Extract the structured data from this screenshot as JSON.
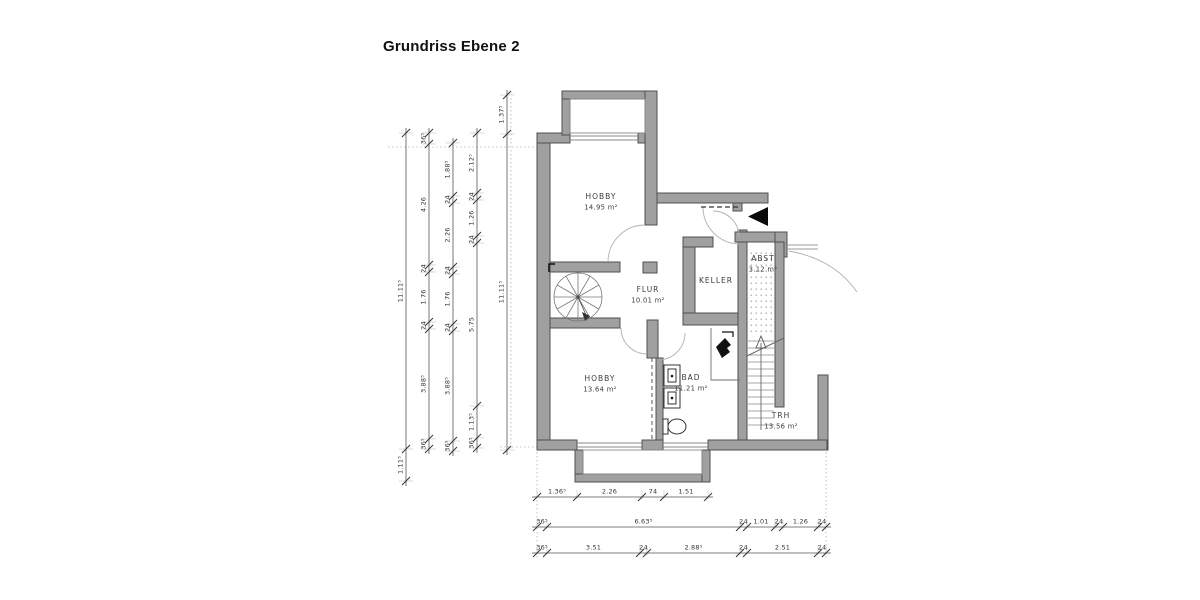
{
  "title": "Grundriss Ebene 2",
  "rooms": [
    {
      "name": "HOBBY",
      "area": "14.95 m²",
      "x": 601,
      "y": 199
    },
    {
      "name": "FLUR",
      "area": "10.01 m²",
      "x": 648,
      "y": 292
    },
    {
      "name": "KELLER",
      "area": "",
      "x": 716,
      "y": 283
    },
    {
      "name": "ABST",
      "area": "3.12 m²",
      "x": 763,
      "y": 261
    },
    {
      "name": "HOBBY",
      "area": "13.64 m²",
      "x": 600,
      "y": 381
    },
    {
      "name": "BAD",
      "area": "11.21 m²",
      "x": 691,
      "y": 380
    },
    {
      "name": "TRH",
      "area": "13.56 m²",
      "x": 781,
      "y": 418
    }
  ],
  "dim_chains": [
    {
      "dir": "v",
      "pos": 406,
      "ticks": [
        133,
        449,
        481
      ],
      "labels": [
        "11.11⁵",
        "1.11⁵"
      ]
    },
    {
      "dir": "v",
      "pos": 429,
      "ticks": [
        133,
        144,
        265,
        272,
        322,
        329,
        439,
        449
      ],
      "labels": [
        "36⁵",
        "4.26",
        "24",
        "1.76",
        "24",
        "3.88⁵",
        "36⁵"
      ]
    },
    {
      "dir": "v",
      "pos": 453,
      "ticks": [
        143,
        196,
        203,
        267,
        274,
        324,
        331,
        441,
        451
      ],
      "labels": [
        "1.88⁵",
        "24",
        "2.26",
        "24",
        "1.76",
        "24",
        "3.88⁵",
        "36⁵"
      ]
    },
    {
      "dir": "v",
      "pos": 477,
      "ticks": [
        133,
        193,
        200,
        236,
        243,
        406,
        438,
        448
      ],
      "labels": [
        "2.12⁵",
        "24",
        "1.26",
        "24",
        "5.75",
        "1.13⁵",
        "36⁵"
      ]
    },
    {
      "dir": "v",
      "pos": 507,
      "ticks": [
        95,
        134,
        450
      ],
      "labels": [
        "1.37⁵",
        "11.11⁵"
      ]
    },
    {
      "dir": "h",
      "pos": 497,
      "ticks": [
        537,
        577,
        642,
        664,
        708
      ],
      "labels": [
        "1.36⁵",
        "2.26",
        "74",
        "1.51"
      ]
    },
    {
      "dir": "h",
      "pos": 527,
      "ticks": [
        537,
        547,
        740,
        747,
        775,
        783,
        818,
        826
      ],
      "labels": [
        "36⁵",
        "6.63⁵",
        "24",
        "1.01",
        "24",
        "1.26",
        "24"
      ]
    },
    {
      "dir": "h",
      "pos": 553,
      "ticks": [
        537,
        547,
        640,
        647,
        740,
        747,
        818,
        826
      ],
      "labels": [
        "36⁵",
        "3.51",
        "24",
        "2.88⁵",
        "24",
        "2.51",
        "24"
      ]
    }
  ],
  "colors": {
    "wall_fill": "#a0a0a0",
    "wall_outline": "#4f4f4f",
    "label_text": "#3c3c3c",
    "dim_text": "#333333",
    "entrance_arrow": "#0a0a0a"
  }
}
